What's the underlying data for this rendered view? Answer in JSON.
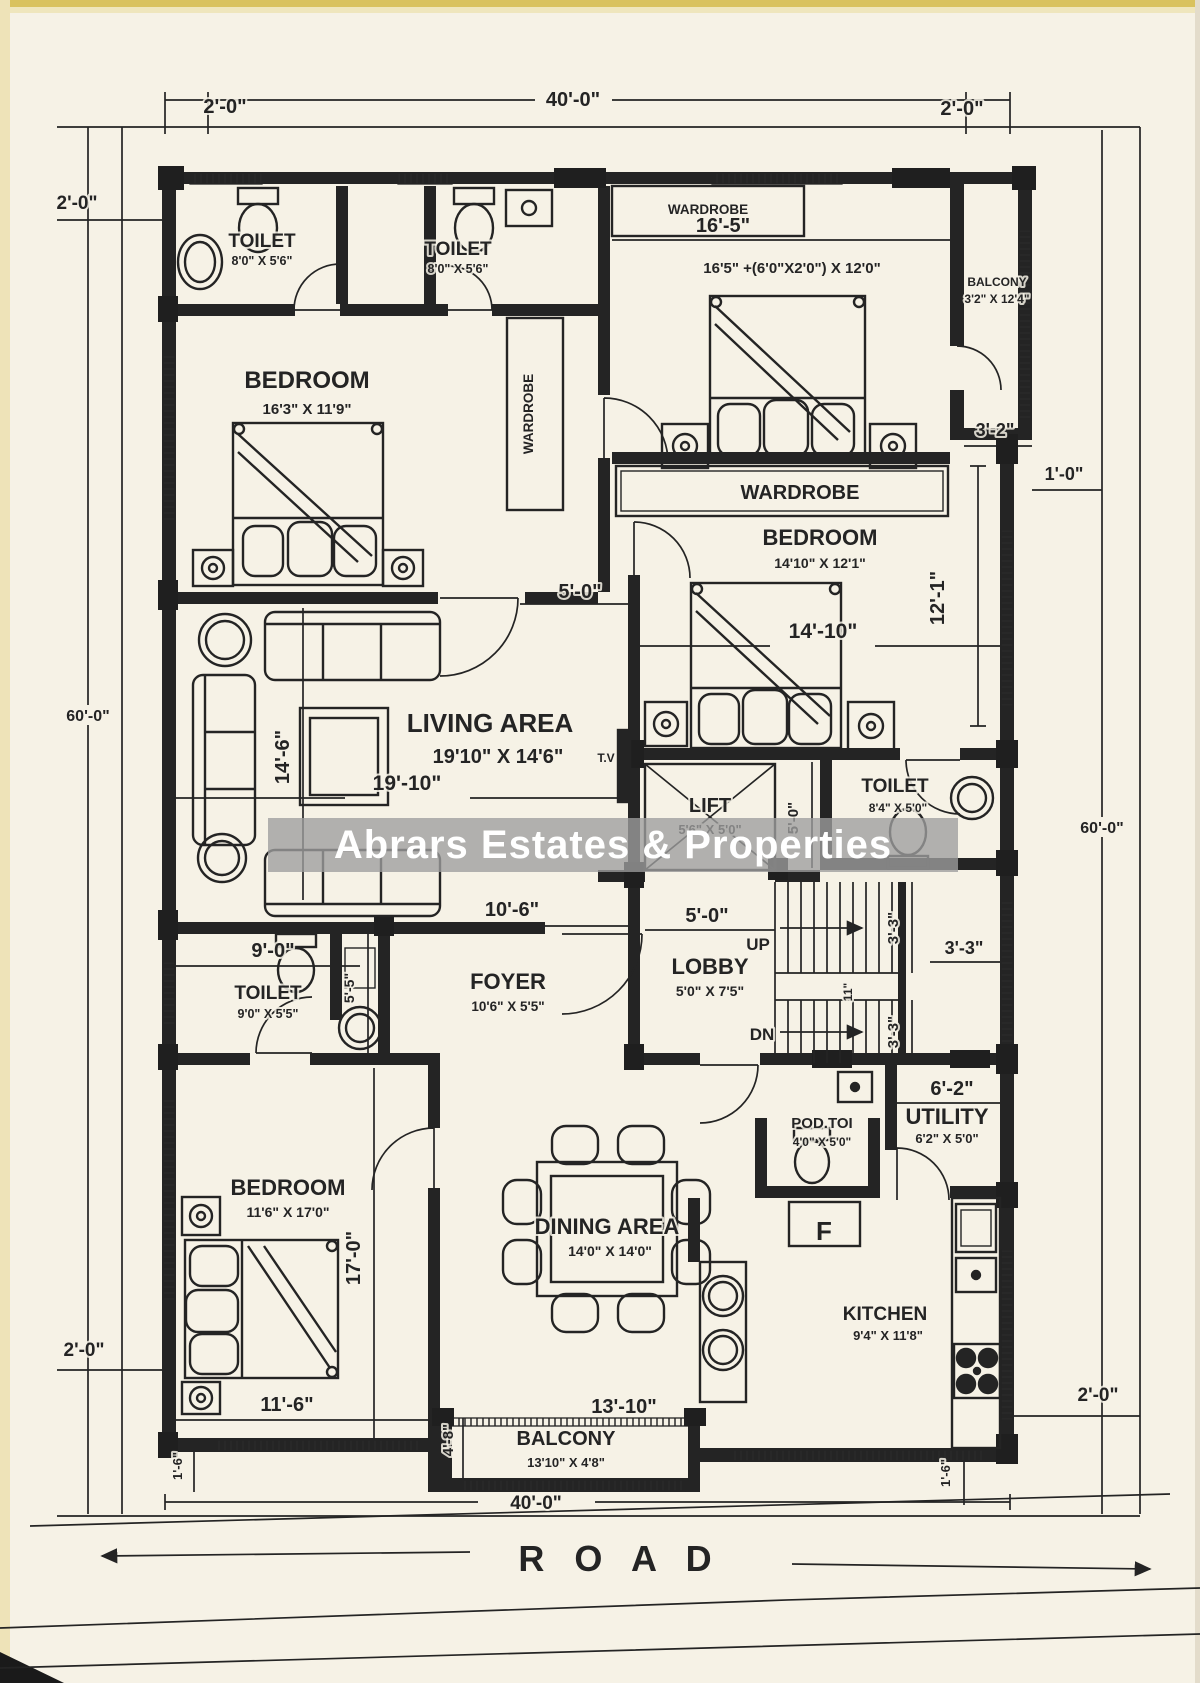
{
  "watermark": "Abrars Estates & Properties",
  "road_label": "R O A D",
  "colors": {
    "paper": "#f6f2e6",
    "ink": "#242424",
    "block": "#1f1f1f",
    "wmbg": "rgba(158,158,158,0.78)",
    "wmtx": "#ffffff",
    "scan": "#d9c25f"
  },
  "rooms": {
    "toilet_tl": {
      "name": "TOILET",
      "size": "8'0\" X 5'6\""
    },
    "toilet_tm": {
      "name": "TOILET",
      "size": "8'0\" X 5'6\""
    },
    "wardrobe_top": {
      "name": "WARDROBE"
    },
    "bedroom_tr": {
      "size": "16'5\" +(6'0\"X2'0\") X 12'0\""
    },
    "balcony_tr": {
      "name": "BALCONY",
      "size": "3'2\" X 12'4\""
    },
    "bedroom_tl": {
      "name": "BEDROOM",
      "size": "16'3\" X 11'9\""
    },
    "wardrobe_left": {
      "name": "WARDROBE"
    },
    "wardrobe_mid": {
      "name": "WARDROBE"
    },
    "bedroom_mr": {
      "name": "BEDROOM",
      "size": "14'10\" X 12'1\""
    },
    "living": {
      "name": "LIVING AREA",
      "size": "19'10\" X 14'6\""
    },
    "tv": {
      "name": "T.V"
    },
    "lift": {
      "name": "LIFT",
      "size": "5'6\" X 5'0\""
    },
    "toilet_mr": {
      "name": "TOILET",
      "size": "8'4\" X 5'0\""
    },
    "lobby": {
      "name": "LOBBY",
      "size": "5'0\" X 7'5\""
    },
    "up": "UP",
    "dn": "DN",
    "toilet_bl": {
      "name": "TOILET",
      "size": "9'0\" X 5'5\""
    },
    "foyer": {
      "name": "FOYER",
      "size": "10'6\" X 5'5\""
    },
    "bedroom_bl": {
      "name": "BEDROOM",
      "size": "11'6\" X 17'0\""
    },
    "dining": {
      "name": "DINING AREA",
      "size": "14'0\" X 14'0\""
    },
    "podtoi": {
      "name": "POD.TOI",
      "size": "4'0\" X 5'0\""
    },
    "fridge": "F",
    "utility": {
      "name": "UTILITY",
      "size": "6'2\" X 5'0\""
    },
    "kitchen": {
      "name": "KITCHEN",
      "size": "9'4\" X 11'8\""
    },
    "balcony_b": {
      "name": "BALCONY",
      "size": "13'10\" X 4'8\""
    }
  },
  "dims": {
    "top_40": "40'-0\"",
    "bottom_40": "40'-0\"",
    "left_60": "60'-0\"",
    "right_60": "60'-0\"",
    "tl_2": "2'-0\"",
    "tr_2": "2'-0\"",
    "left_2": "2'-0\"",
    "bl_2": "2'-0\"",
    "br_2": "2'-0\"",
    "w165": "16'-5\"",
    "d32": "3'-2\"",
    "d10": "1'-0\"",
    "d50_open": "5'-0\"",
    "d1410": "14'-10\"",
    "d121": "12'-1\"",
    "d146": "14'-6\"",
    "d1910": "19'-10\"",
    "d50_lift": "5'-0\"",
    "d50_lobby": "5'-0\"",
    "d90": "9'-0\"",
    "d55": "5'-5\"",
    "d106": "10'-6\"",
    "d33_up": "3'-3\"",
    "d33_dn": "3'-3\"",
    "d33_r": "3'-3\"",
    "d11": "11\"",
    "d62": "6'-2\"",
    "d170": "17'-0\"",
    "d116": "11'-6\"",
    "d1310": "13'-10\"",
    "d48": "4'-8\"",
    "d16_l": "1'-6\"",
    "d16_r": "1'-6\""
  }
}
